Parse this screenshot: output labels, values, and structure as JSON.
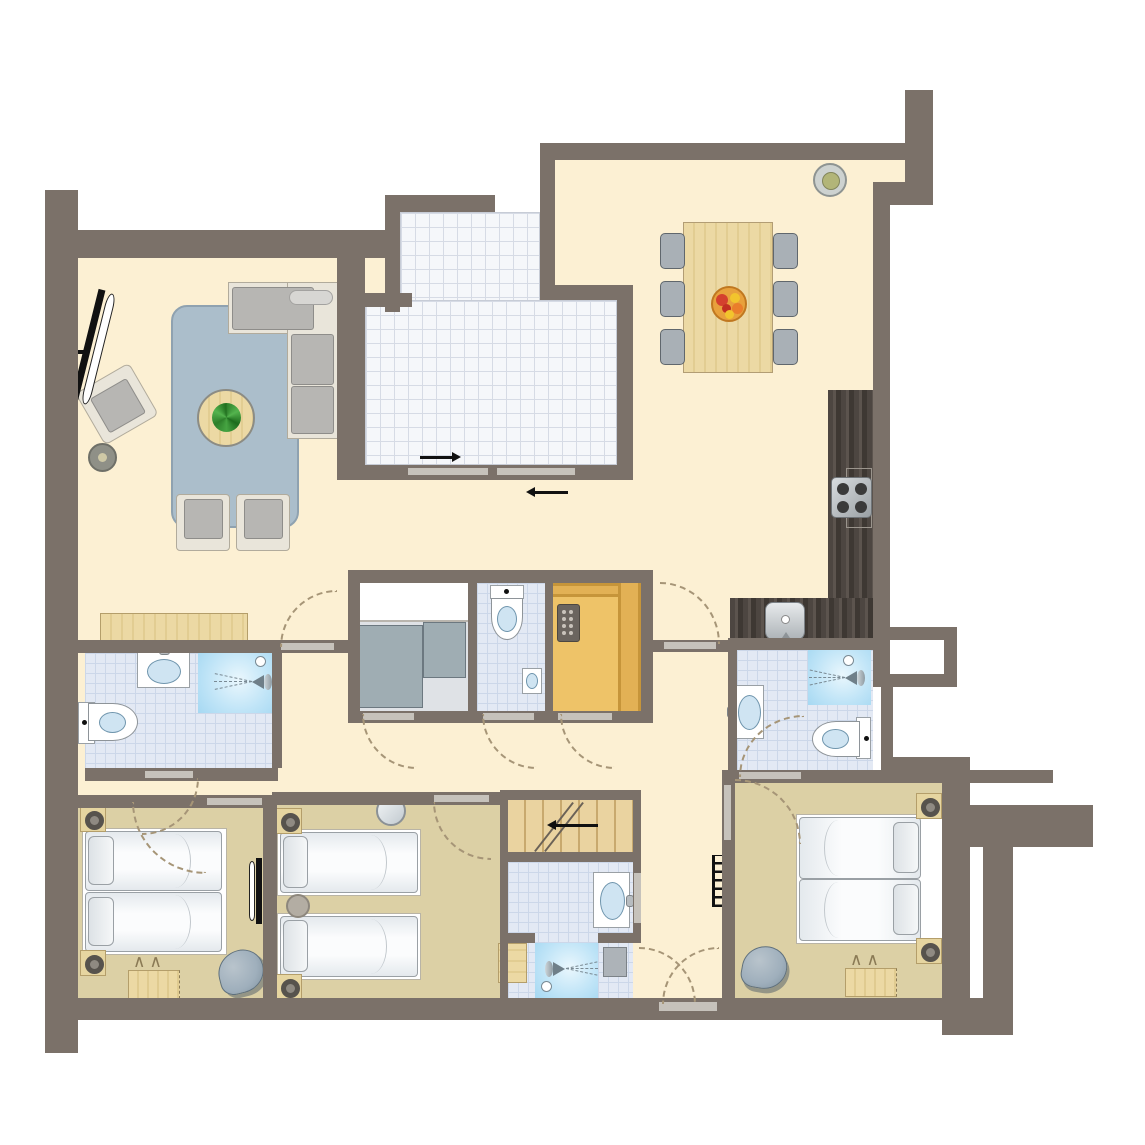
{
  "plan": {
    "kind": "apartment-floor-plan",
    "rooms": [
      "living-room",
      "terrace",
      "dining-area",
      "kitchen",
      "hallway",
      "bathroom-left",
      "storage-room",
      "toilet-room",
      "sauna",
      "bathroom-right",
      "bathroom-middle",
      "shower-room",
      "bedroom-1",
      "bedroom-2",
      "bedroom-3",
      "stairs",
      "entrance"
    ]
  },
  "colors": {
    "wall": "#7b7169",
    "floor": "#fcf0d3",
    "bedroom_floor": "#dcd0a5",
    "bath_tile": "#e3e9f4",
    "bath_tile_line": "#ccd7e9",
    "terrace_tile": "#f5f7fa",
    "terrace_tile_line": "#d6dbe5",
    "shower": "#bfe4f7",
    "wood": "#ecd9a4",
    "wood_dark": "#c9b380",
    "sauna": "#eec368",
    "sauna_band": "#c6953a",
    "kitchen": "#4d4641",
    "rug": "#abbecb",
    "sofa": "#b7b6b3",
    "frame": "#e9e5da",
    "bed": "#f7f9fa",
    "bed_line": "#9aa0a5",
    "door_arc": "#a69577",
    "threshold": "#c6c2bb",
    "gray_unit": "#9fadb3",
    "beanbag": "#9fafbc",
    "plant": "#3a9a35",
    "bowl": "#e8a13c",
    "black": "#1a1a1a"
  },
  "icons": {
    "shower-head-icon": "triangle+dashed-spray",
    "ceiling-light-icon": "concentric-circles",
    "wall-light-icon": "ring-on-wood-square",
    "radiator-icon": "black-comb",
    "stove-icon": "four-burner-circles",
    "sauna-heater-icon": "dark-box-dot-grid",
    "door-swing-icon": "dashed-quarter-arc",
    "sliding-door-icon": "gray-panels-with-arrows",
    "stairs-arrow-icon": "left-arrow",
    "plant-icon": "green-rosette",
    "fruit-bowl-icon": "orange-bowl-with-fruit",
    "tv-icon": "slanted-black-panel"
  }
}
